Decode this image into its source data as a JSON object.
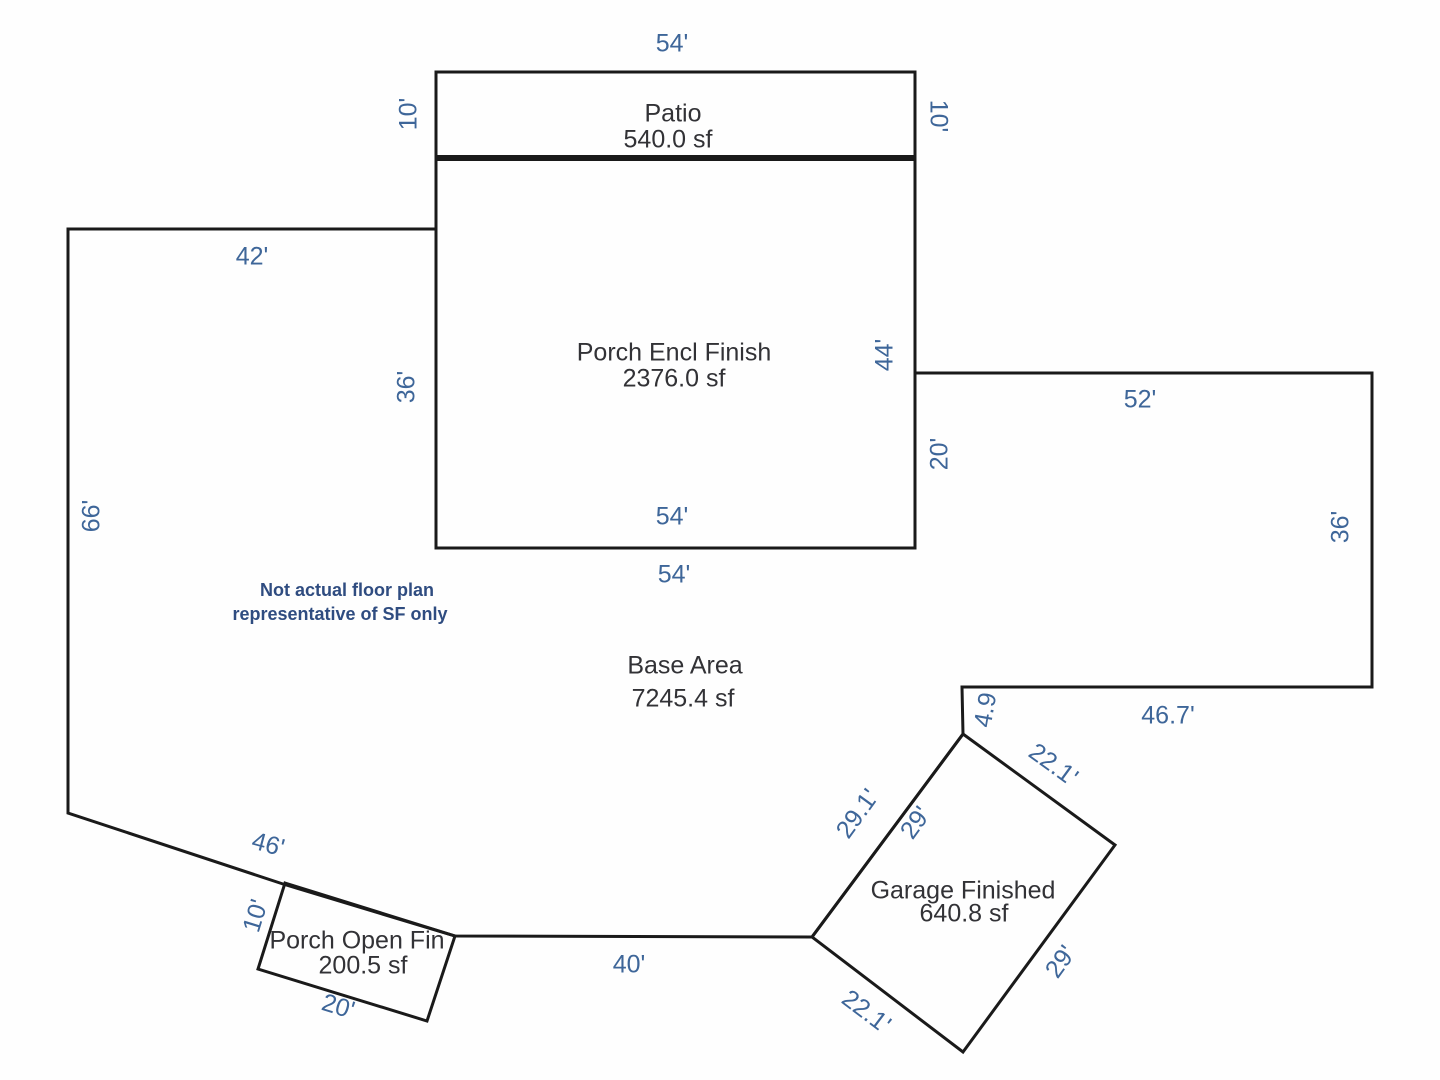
{
  "title": "Floor plan square-footage sketch",
  "note": {
    "line1": "Not actual floor plan",
    "line2": "representative of SF only"
  },
  "areas": {
    "patio": {
      "name": "Patio",
      "sf": "540.0 sf"
    },
    "porch_encl": {
      "name": "Porch Encl Finish",
      "sf": "2376.0 sf"
    },
    "base": {
      "name": "Base Area",
      "sf": "7245.4 sf"
    },
    "garage": {
      "name": "Garage Finished",
      "sf": "640.8 sf"
    },
    "porch_open": {
      "name": "Porch Open Fin",
      "sf": "200.5 sf"
    }
  },
  "dims": {
    "patio_top": "54'",
    "patio_left": "10'",
    "patio_right": "10'",
    "base_top": "42'",
    "porch_left": "36'",
    "porch_right": "44'",
    "wing_left": "20'",
    "wing_top": "52'",
    "base_left": "66'",
    "porch_bottom_inner": "54'",
    "porch_bottom_outer": "54'",
    "wing_right": "36'",
    "wing_bottom": "46.7'",
    "notch": "4.9",
    "garage_top_right": "22.1'",
    "base_garage_edge": "29.1'",
    "garage_top_left": "29'",
    "garage_bottom_right": "29'",
    "garage_bottom_left": "22.1'",
    "base_diagonal": "46'",
    "open_left": "10'",
    "open_bottom": "20'",
    "base_bottom": "40'"
  },
  "colors": {
    "line": "#1a1a1a",
    "dimension_text": "#3e6699",
    "room_text": "#323236",
    "note_text": "#2f4c80",
    "background": "#fefefe"
  }
}
